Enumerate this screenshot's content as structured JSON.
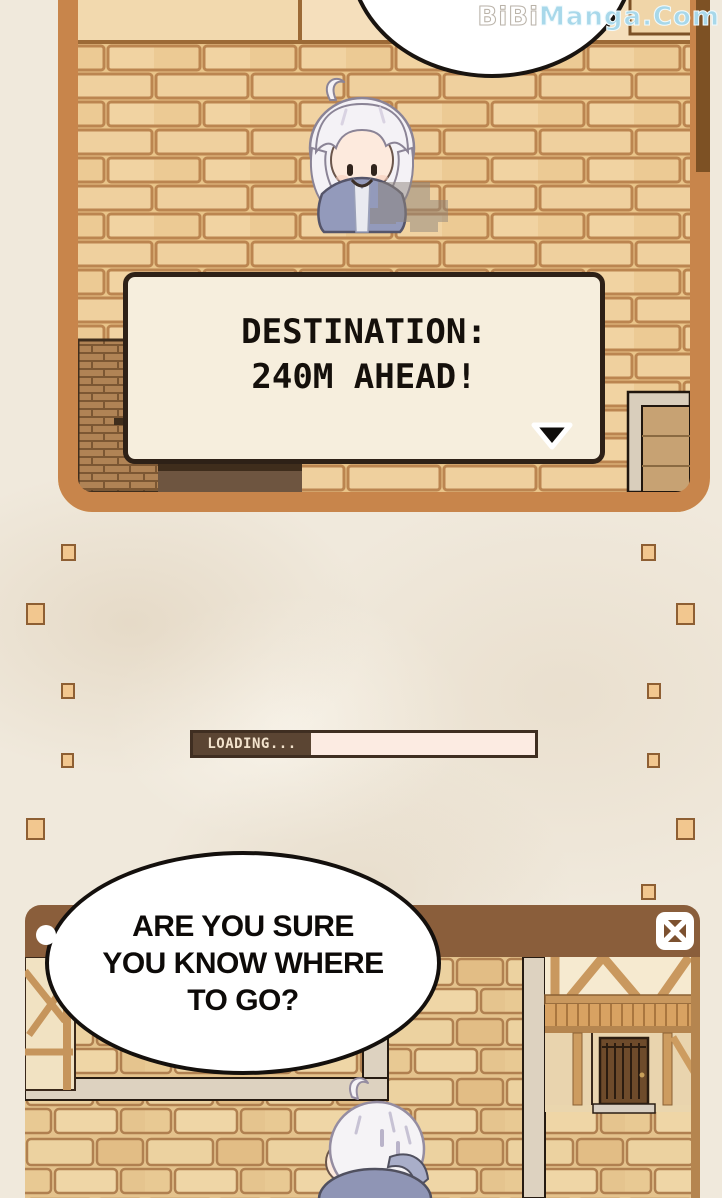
{
  "watermark": {
    "brand_white": "BiBi",
    "brand_blue": "Manga.Com"
  },
  "top_panel": {
    "dialog_box": {
      "line1": "DESTINATION:",
      "line2": "240M AHEAD!",
      "continue_icon": "down-triangle"
    }
  },
  "middle": {
    "loading": {
      "label": "LOADING...",
      "progress_percent": 0
    }
  },
  "speech_bubble": {
    "line1": "ARE YOU SURE",
    "line2": "YOU KNOW WHERE",
    "line3": "TO GO?"
  },
  "bottom_panel": {
    "close_icon": "boxed-x"
  },
  "colors": {
    "page_bg": "#f0e9dc",
    "panel_frame": "#c8854b",
    "brick": "#efd09e",
    "mortar": "#bb8550",
    "dialog_bg": "#f6eedd",
    "dialog_border": "#2e2117",
    "title_bar_brown": "#8a5e3b",
    "loading_label_bg": "#5b4533",
    "loading_track": "#fcebe2",
    "decor_square_fill": "#f2c78f",
    "decor_square_border": "#8e5f33",
    "watermark_blue": "#a8d8ea",
    "character_cloak": "#939abb",
    "character_hair": "#f4f2f6"
  }
}
